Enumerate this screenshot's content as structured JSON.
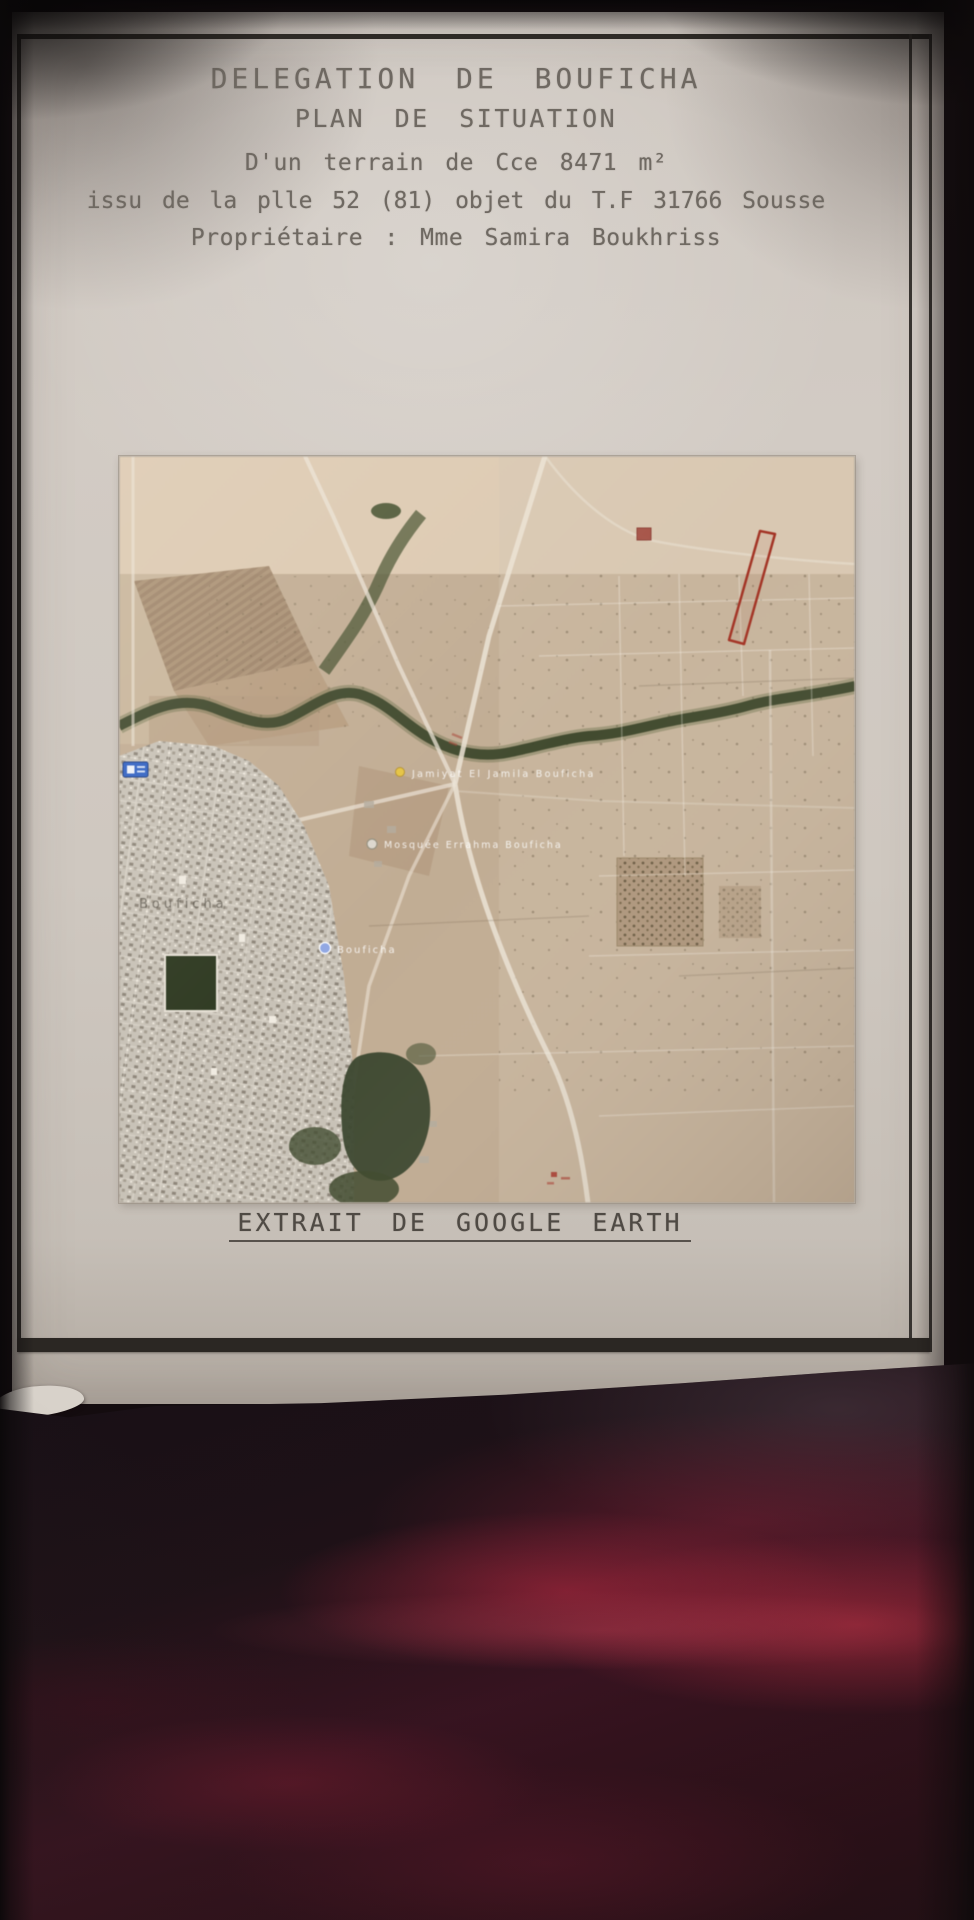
{
  "document": {
    "title": "DELEGATION DE BOUFICHA",
    "subtitle": "PLAN DE SITUATION",
    "line_area": "D'un terrain de Cce 8471 m²",
    "line_parcel": "issu de la plle 52 (81) objet du T.F 31766 Sousse",
    "line_owner": "Propriétaire : Mme Samira Boukhriss",
    "map_caption": "EXTRAIT DE GOOGLE EARTH"
  },
  "map": {
    "labels": {
      "poi1": "Jamiyat El Jamila Bouficha",
      "poi2": "Mosquée Errahma Bouficha",
      "town": "Bouficha",
      "town_pin": "Bouficha"
    },
    "markers": [
      "red-parcel-outline",
      "red-square-marker",
      "yellow-placemark-dot",
      "white-photo-dot",
      "blue-sign-icon",
      "blue-town-dot"
    ],
    "colors": {
      "parcel_outline": "#ab3222",
      "terrain_base": "#c3ad92",
      "river_green": "#3d4729",
      "road_light": "#ece3d4"
    }
  },
  "colors": {
    "paper": "#cdc6bf",
    "frame_ink": "#2e2a26",
    "text_ink": "#6f6962",
    "fabric_red": "#a2263c",
    "fabric_dark": "#171016"
  }
}
